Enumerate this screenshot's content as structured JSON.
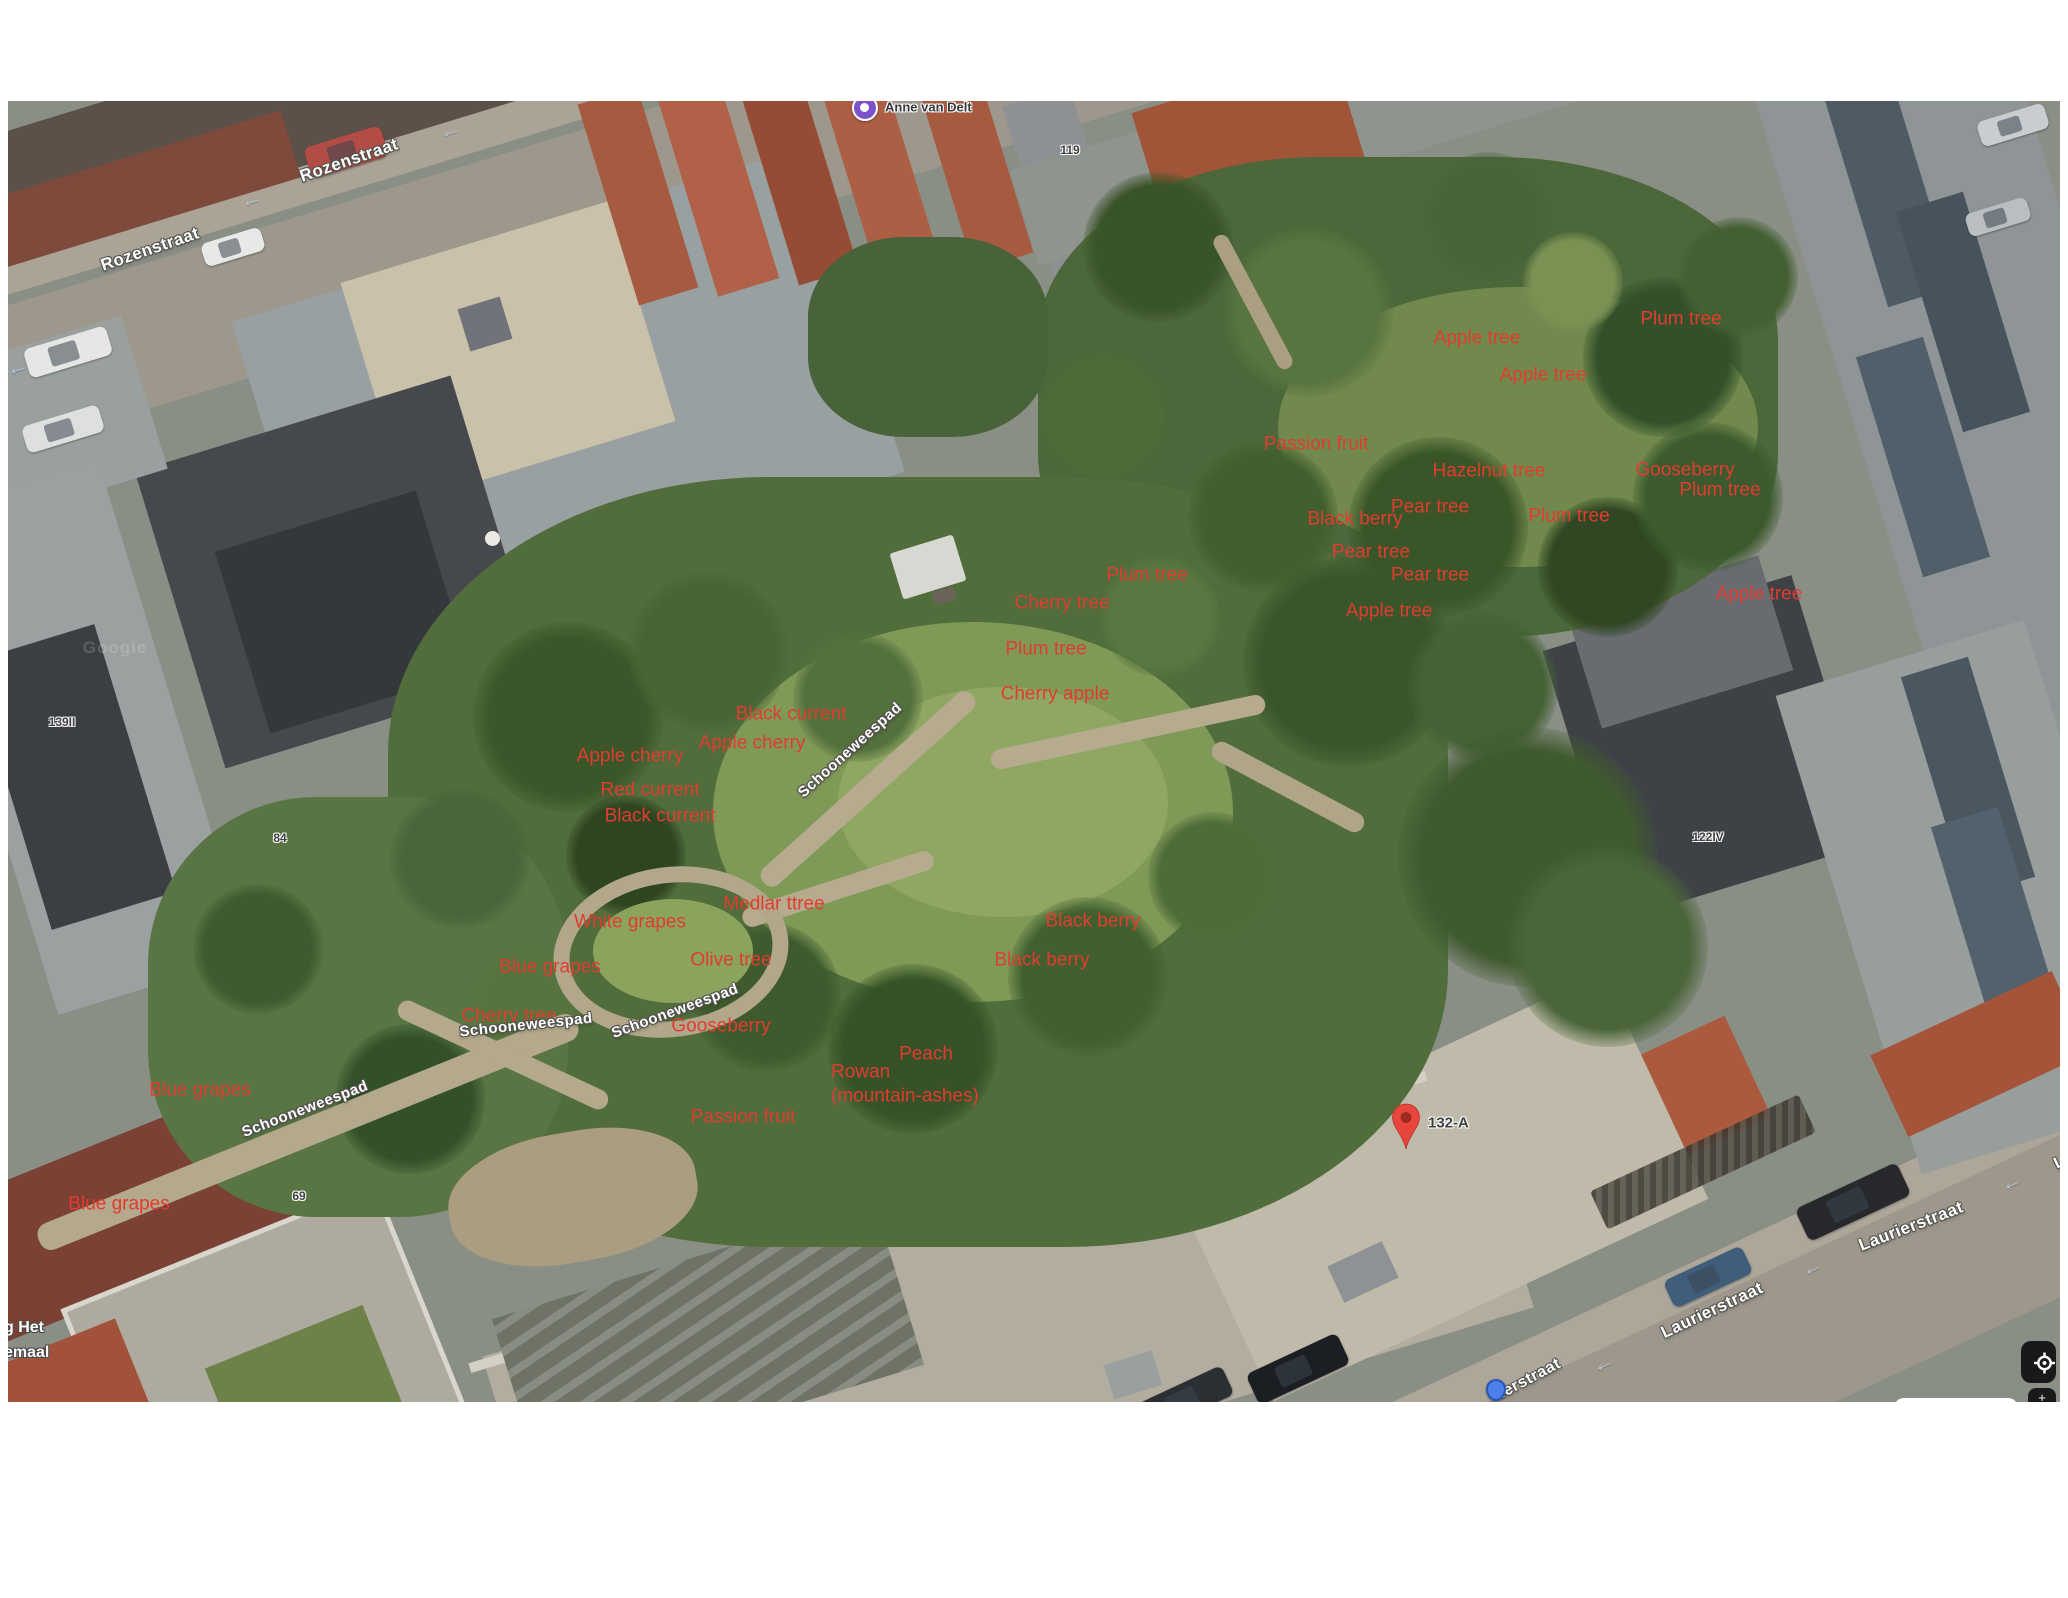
{
  "map": {
    "poi_top": {
      "name": "Anne van Delt"
    },
    "marker": {
      "label": "132-A"
    },
    "watermark": "Google",
    "plant_labels": [
      {
        "text": "Apple tree",
        "x": 1469,
        "y": 237
      },
      {
        "text": "Apple tree",
        "x": 1535,
        "y": 274
      },
      {
        "text": "Plum tree",
        "x": 1673,
        "y": 218
      },
      {
        "text": "Passion fruit",
        "x": 1308,
        "y": 343
      },
      {
        "text": "Hazelnut tree",
        "x": 1481,
        "y": 370
      },
      {
        "text": "Gooseberry",
        "x": 1677,
        "y": 369
      },
      {
        "text": "Plum tree",
        "x": 1712,
        "y": 389
      },
      {
        "text": "Pear tree",
        "x": 1422,
        "y": 406
      },
      {
        "text": "Black berry",
        "x": 1347,
        "y": 418
      },
      {
        "text": "Plum tree",
        "x": 1561,
        "y": 415
      },
      {
        "text": "Pear tree",
        "x": 1363,
        "y": 451
      },
      {
        "text": "Pear tree",
        "x": 1422,
        "y": 474
      },
      {
        "text": "Apple tree",
        "x": 1381,
        "y": 510
      },
      {
        "text": "Apple tree",
        "x": 1751,
        "y": 493
      },
      {
        "text": "Plum tree",
        "x": 1139,
        "y": 474
      },
      {
        "text": "Cherry tree",
        "x": 1054,
        "y": 502
      },
      {
        "text": "Plum tree",
        "x": 1038,
        "y": 548
      },
      {
        "text": "Cherry apple",
        "x": 1047,
        "y": 593
      },
      {
        "text": "Black current",
        "x": 783,
        "y": 613
      },
      {
        "text": "Apple cherry",
        "x": 744,
        "y": 642
      },
      {
        "text": "Apple cherry",
        "x": 622,
        "y": 655
      },
      {
        "text": "Red current",
        "x": 642,
        "y": 689
      },
      {
        "text": "Black current",
        "x": 652,
        "y": 715
      },
      {
        "text": "Medlar ttree",
        "x": 766,
        "y": 803
      },
      {
        "text": "White grapes",
        "x": 622,
        "y": 821
      },
      {
        "text": "Olive tree",
        "x": 723,
        "y": 859
      },
      {
        "text": "Blue grapes",
        "x": 542,
        "y": 866
      },
      {
        "text": "Cherry tree",
        "x": 501,
        "y": 915
      },
      {
        "text": "Gooseberry",
        "x": 713,
        "y": 925
      },
      {
        "text": "Black berry",
        "x": 1085,
        "y": 820
      },
      {
        "text": "Black berry",
        "x": 1034,
        "y": 859
      },
      {
        "text": "Peach",
        "x": 918,
        "y": 953
      },
      {
        "text": "Rowan",
        "x": 823,
        "y": 971,
        "align": "left"
      },
      {
        "text": "(mountain-ashes)",
        "x": 823,
        "y": 995,
        "align": "left"
      },
      {
        "text": "Passion fruit",
        "x": 735,
        "y": 1016
      },
      {
        "text": "Blue grapes",
        "x": 192,
        "y": 989
      },
      {
        "text": "Blue grapes",
        "x": 111,
        "y": 1103
      }
    ],
    "street_labels": [
      {
        "text": "Rozenstraat",
        "x": 341,
        "y": 59,
        "rot": -19,
        "size": 17
      },
      {
        "text": "Rozenstraat",
        "x": 142,
        "y": 148,
        "rot": -19,
        "size": 17
      },
      {
        "text": "Schooneweespad",
        "x": 842,
        "y": 649,
        "rot": -42,
        "size": 15
      },
      {
        "text": "Schooneweespad",
        "x": 518,
        "y": 924,
        "rot": -6,
        "size": 15
      },
      {
        "text": "Schooneweespad",
        "x": 667,
        "y": 910,
        "rot": -20,
        "size": 15
      },
      {
        "text": "Schooneweespad",
        "x": 297,
        "y": 1008,
        "rot": -21,
        "size": 15
      },
      {
        "text": "Laurierstraat",
        "x": 1903,
        "y": 1125,
        "rot": -21,
        "size": 17
      },
      {
        "text": "Laurierstraat",
        "x": 1704,
        "y": 1209,
        "rot": -25,
        "size": 17
      },
      {
        "text": "ierstraat",
        "x": 1522,
        "y": 1278,
        "rot": -28,
        "size": 16
      },
      {
        "text": "La",
        "x": 2056,
        "y": 1060,
        "rot": -25,
        "size": 16
      }
    ],
    "number_labels": [
      {
        "text": "119",
        "x": 1062,
        "y": 49
      },
      {
        "text": "139II",
        "x": 54,
        "y": 621
      },
      {
        "text": "84",
        "x": 272,
        "y": 737
      },
      {
        "text": "122IV",
        "x": 1700,
        "y": 736
      },
      {
        "text": "69",
        "x": 291,
        "y": 1095
      },
      {
        "text": "132-A",
        "x": 1420,
        "y": 1022,
        "size": 15,
        "align": "left"
      }
    ],
    "partial_poi_left": {
      "lines": [
        "g Het",
        "emaal"
      ]
    },
    "arrows": [
      {
        "x": 442,
        "y": 29,
        "rot": -17
      },
      {
        "x": 243,
        "y": 98,
        "rot": -17
      },
      {
        "x": 9,
        "y": 266,
        "rot": -17
      },
      {
        "x": 2003,
        "y": 1081,
        "rot": -25
      },
      {
        "x": 1804,
        "y": 1166,
        "rot": -25
      },
      {
        "x": 1595,
        "y": 1262,
        "rot": -25
      }
    ],
    "colors": {
      "plant_label": "#e23b30",
      "street_label": "#ffffff",
      "number_label": "#3e4043",
      "red_pin": "#e8453c",
      "red_pin_inner": "#9c2b22",
      "poi_pin": "#7b52c9",
      "blue_dot": "#4a80e8",
      "control_bg": "#19191a"
    }
  }
}
